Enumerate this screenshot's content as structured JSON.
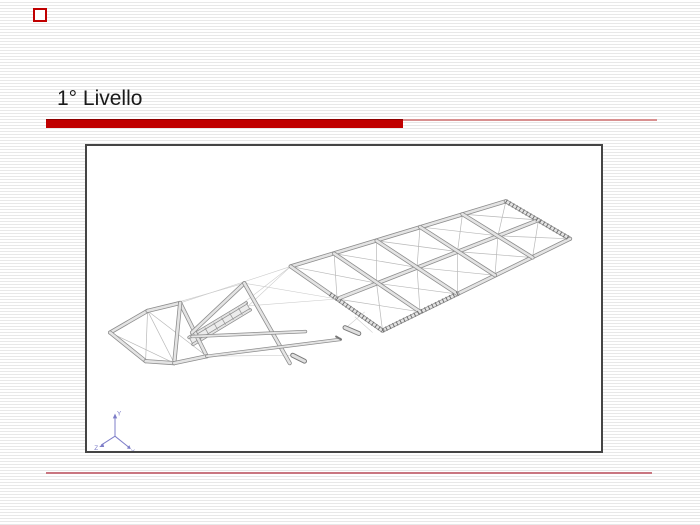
{
  "slide": {
    "title": "1° Livello",
    "colors": {
      "accent_red": "#c00000",
      "title_underline_thin": "#d89090",
      "footer_line": "#c97680",
      "background_stripe": "#e8e8e8",
      "frame_border": "#454545",
      "axis": "#7d7dc8"
    }
  },
  "figure": {
    "name": "structural-floor-framing-isometric-wireframe",
    "axis_triad": {
      "x_label": "X",
      "y_label": "Y",
      "z_label": "Z"
    }
  }
}
